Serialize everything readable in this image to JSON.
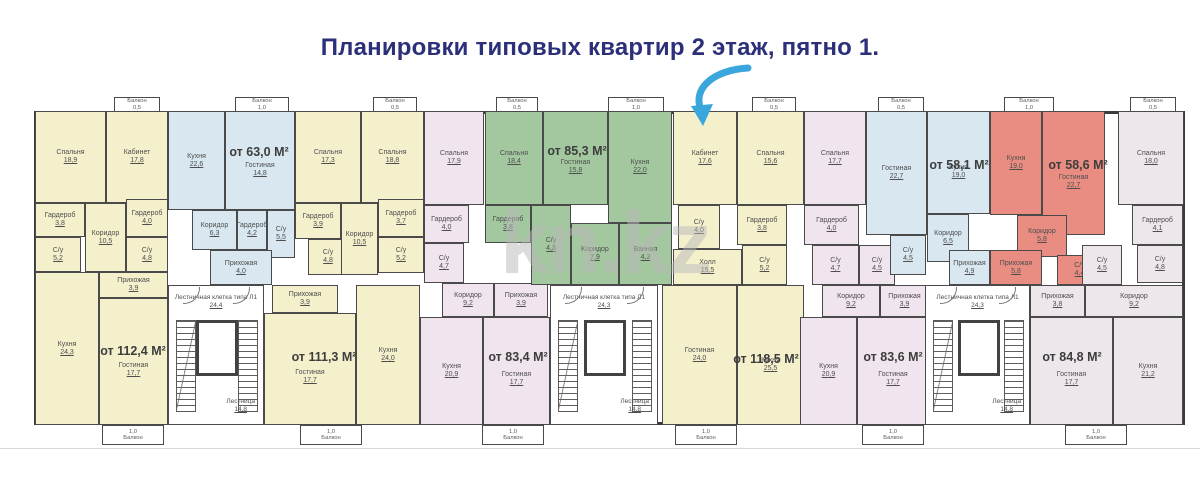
{
  "title": "Планировки типовых квартир 2 этаж, пятно 1.",
  "watermark": "kn.kz",
  "palette": {
    "yellow": "#f4f0cc",
    "blue": "#d8e7f0",
    "lavender": "#f0e4ee",
    "green": "#a3c89f",
    "red": "#e98d82",
    "pink": "#ede7ec",
    "wall": "#3a3a3a",
    "title": "#2c2f79",
    "arrow": "#3aa6dc",
    "watermark_gray": "#b9b9b9",
    "room_text": "#4e4e4e"
  },
  "plan": {
    "rooms": [
      {
        "n": "Спальня",
        "a": "18,9",
        "c": "yellow",
        "r": [
          3,
          16,
          71,
          92
        ]
      },
      {
        "n": "Кабинет",
        "a": "17,8",
        "c": "yellow",
        "r": [
          74,
          16,
          62,
          92
        ]
      },
      {
        "n": "Гардероб",
        "a": "3,8",
        "c": "yellow",
        "r": [
          3,
          108,
          50,
          34
        ]
      },
      {
        "n": "Гардероб",
        "a": "4,0",
        "c": "yellow",
        "r": [
          94,
          104,
          42,
          38
        ]
      },
      {
        "n": "С/у",
        "a": "5,2",
        "c": "yellow",
        "r": [
          3,
          142,
          46,
          35
        ]
      },
      {
        "n": "Коридор",
        "a": "10,5",
        "c": "yellow",
        "r": [
          53,
          108,
          41,
          69
        ]
      },
      {
        "n": "С/у",
        "a": "4,8",
        "c": "yellow",
        "r": [
          94,
          142,
          42,
          35
        ]
      },
      {
        "n": "Кухня",
        "a": "24,3",
        "c": "yellow",
        "r": [
          3,
          177,
          64,
          153
        ]
      },
      {
        "n": "Прихожая",
        "a": "3,9",
        "c": "yellow",
        "r": [
          67,
          177,
          69,
          26
        ]
      },
      {
        "n": "Гостиная",
        "a": "17,7",
        "c": "yellow",
        "r": [
          67,
          203,
          69,
          127
        ],
        "d": 16
      },
      {
        "n": "Кухня",
        "a": "22,6",
        "c": "blue",
        "r": [
          136,
          16,
          57,
          99
        ]
      },
      {
        "n": "Гостиная",
        "a": "14,8",
        "c": "blue",
        "r": [
          193,
          16,
          70,
          99
        ],
        "d": 18
      },
      {
        "n": "Коридор",
        "a": "6,3",
        "c": "blue",
        "r": [
          160,
          115,
          45,
          40
        ]
      },
      {
        "n": "Гардероб",
        "a": "4,2",
        "c": "blue",
        "r": [
          205,
          115,
          30,
          40
        ]
      },
      {
        "n": "С/у",
        "a": "5,5",
        "c": "blue",
        "r": [
          235,
          115,
          28,
          48
        ]
      },
      {
        "n": "Прихожая",
        "a": "4,0",
        "c": "blue",
        "r": [
          178,
          155,
          62,
          35
        ]
      },
      {
        "n": "Спальня",
        "a": "17,3",
        "c": "yellow",
        "r": [
          263,
          16,
          66,
          92
        ]
      },
      {
        "n": "Спальня",
        "a": "18,8",
        "c": "yellow",
        "r": [
          329,
          16,
          63,
          92
        ]
      },
      {
        "n": "Гардероб",
        "a": "3,9",
        "c": "yellow",
        "r": [
          263,
          108,
          46,
          36
        ]
      },
      {
        "n": "Гардероб",
        "a": "3,7",
        "c": "yellow",
        "r": [
          346,
          104,
          46,
          38
        ]
      },
      {
        "n": "С/у",
        "a": "4,8",
        "c": "yellow",
        "r": [
          276,
          144,
          40,
          36
        ]
      },
      {
        "n": "Коридор",
        "a": "10,5",
        "c": "yellow",
        "r": [
          309,
          108,
          37,
          72
        ]
      },
      {
        "n": "С/у",
        "a": "5,2",
        "c": "yellow",
        "r": [
          346,
          142,
          46,
          36
        ]
      },
      {
        "n": "Прихожая",
        "a": "3,9",
        "c": "yellow",
        "r": [
          240,
          190,
          66,
          28
        ]
      },
      {
        "n": "Гостиная",
        "a": "17,7",
        "c": "yellow",
        "r": [
          232,
          218,
          92,
          112
        ],
        "d": 16
      },
      {
        "n": "Кухня",
        "a": "24,0",
        "c": "yellow",
        "r": [
          324,
          190,
          64,
          140
        ]
      },
      {
        "n": "Спальня",
        "a": "17,9",
        "c": "lavender",
        "r": [
          392,
          16,
          60,
          94
        ]
      },
      {
        "n": "Гардероб",
        "a": "4,0",
        "c": "lavender",
        "r": [
          392,
          110,
          45,
          38
        ]
      },
      {
        "n": "С/у",
        "a": "4,7",
        "c": "lavender",
        "r": [
          392,
          148,
          40,
          40
        ]
      },
      {
        "n": "Коридор",
        "a": "9,2",
        "c": "lavender",
        "r": [
          410,
          188,
          52,
          34
        ]
      },
      {
        "n": "Прихожая",
        "a": "3,9",
        "c": "lavender",
        "r": [
          462,
          188,
          54,
          34
        ]
      },
      {
        "n": "Кухня",
        "a": "20,9",
        "c": "lavender",
        "r": [
          388,
          222,
          63,
          108
        ]
      },
      {
        "n": "Гостиная",
        "a": "17,7",
        "c": "lavender",
        "r": [
          451,
          222,
          67,
          108
        ],
        "d": 16
      },
      {
        "n": "Спальня",
        "a": "18,4",
        "c": "green",
        "r": [
          453,
          16,
          58,
          94
        ]
      },
      {
        "n": "Гостиная",
        "a": "15,8",
        "c": "green",
        "r": [
          511,
          16,
          65,
          94
        ],
        "d": 18
      },
      {
        "n": "Кухня",
        "a": "22,0",
        "c": "green",
        "r": [
          576,
          16,
          64,
          112
        ]
      },
      {
        "n": "Гардероб",
        "a": "3,8",
        "c": "green",
        "r": [
          453,
          110,
          46,
          38
        ]
      },
      {
        "n": "С/у",
        "a": "4,3",
        "c": "green",
        "r": [
          499,
          110,
          40,
          80
        ]
      },
      {
        "n": "Коридор",
        "a": "7,9",
        "c": "green",
        "r": [
          539,
          128,
          48,
          62
        ]
      },
      {
        "n": "Ванная",
        "a": "4,3",
        "c": "green",
        "r": [
          587,
          128,
          53,
          62
        ]
      },
      {
        "n": "Кабинет",
        "a": "17,6",
        "c": "yellow",
        "r": [
          641,
          16,
          64,
          94
        ]
      },
      {
        "n": "Спальня",
        "a": "15,6",
        "c": "yellow",
        "r": [
          705,
          16,
          67,
          94
        ]
      },
      {
        "n": "С/у",
        "a": "4,0",
        "c": "yellow",
        "r": [
          646,
          110,
          42,
          44
        ]
      },
      {
        "n": "Гардероб",
        "a": "3,8",
        "c": "yellow",
        "r": [
          705,
          110,
          50,
          40
        ]
      },
      {
        "n": "С/у",
        "a": "5,2",
        "c": "yellow",
        "r": [
          710,
          150,
          45,
          40
        ]
      },
      {
        "n": "Холл",
        "a": "15,5",
        "c": "yellow",
        "r": [
          641,
          154,
          69,
          36
        ]
      },
      {
        "n": "Гостиная",
        "a": "24,0",
        "c": "yellow",
        "r": [
          630,
          190,
          75,
          140
        ]
      },
      {
        "n": "Кухня",
        "a": "25,5",
        "c": "yellow",
        "r": [
          705,
          190,
          67,
          140
        ],
        "d": 20
      },
      {
        "n": "Спальня",
        "a": "17,7",
        "c": "lavender",
        "r": [
          772,
          16,
          62,
          94
        ]
      },
      {
        "n": "Гардероб",
        "a": "4,0",
        "c": "lavender",
        "r": [
          772,
          110,
          55,
          40
        ]
      },
      {
        "n": "С/у",
        "a": "4,7",
        "c": "lavender",
        "r": [
          780,
          150,
          47,
          40
        ]
      },
      {
        "n": "С/у",
        "a": "4,5",
        "c": "lavender",
        "r": [
          827,
          150,
          36,
          40
        ]
      },
      {
        "n": "Коридор",
        "a": "9,2",
        "c": "lavender",
        "r": [
          790,
          190,
          58,
          32
        ]
      },
      {
        "n": "Прихожая",
        "a": "3,9",
        "c": "lavender",
        "r": [
          848,
          190,
          49,
          32
        ]
      },
      {
        "n": "Кухня",
        "a": "20,9",
        "c": "lavender",
        "r": [
          768,
          222,
          57,
          108
        ]
      },
      {
        "n": "Гостиная",
        "a": "17,7",
        "c": "lavender",
        "r": [
          825,
          222,
          72,
          108
        ],
        "d": 16
      },
      {
        "n": "Гостиная",
        "a": "22,7",
        "c": "blue",
        "r": [
          834,
          16,
          61,
          124
        ]
      },
      {
        "n": "Кухня",
        "a": "19,0",
        "c": "blue",
        "r": [
          895,
          16,
          63,
          103
        ],
        "d": 18
      },
      {
        "n": "Коридор",
        "a": "6,5",
        "c": "blue",
        "r": [
          895,
          119,
          42,
          48
        ]
      },
      {
        "n": "С/у",
        "a": "4,5",
        "c": "blue",
        "r": [
          858,
          140,
          36,
          40
        ]
      },
      {
        "n": "Прихожая",
        "a": "4,9",
        "c": "blue",
        "r": [
          917,
          155,
          41,
          35
        ]
      },
      {
        "n": "Кухня",
        "a": "19,0",
        "c": "red",
        "r": [
          958,
          16,
          52,
          104
        ]
      },
      {
        "n": "Гостиная",
        "a": "22,7",
        "c": "red",
        "r": [
          1010,
          16,
          63,
          124
        ],
        "d": 18
      },
      {
        "n": "Коридор",
        "a": "5,8",
        "c": "red",
        "r": [
          985,
          120,
          50,
          42
        ]
      },
      {
        "n": "Прихожая",
        "a": "5,8",
        "c": "red",
        "r": [
          958,
          155,
          52,
          35
        ]
      },
      {
        "n": "С/у",
        "a": "4,4",
        "c": "red",
        "r": [
          1025,
          160,
          45,
          30
        ]
      },
      {
        "n": "Спальня",
        "a": "18,0",
        "c": "pink",
        "r": [
          1086,
          16,
          66,
          94
        ]
      },
      {
        "n": "Гардероб",
        "a": "4,1",
        "c": "pink",
        "r": [
          1100,
          110,
          51,
          40
        ]
      },
      {
        "n": "С/у",
        "a": "4,8",
        "c": "pink",
        "r": [
          1105,
          150,
          46,
          38
        ]
      },
      {
        "n": "С/у",
        "a": "4,5",
        "c": "pink",
        "r": [
          1050,
          150,
          40,
          40
        ]
      },
      {
        "n": "Прихожая",
        "a": "3,8",
        "c": "pink",
        "r": [
          998,
          190,
          55,
          32
        ]
      },
      {
        "n": "Коридор",
        "a": "9,2",
        "c": "pink",
        "r": [
          1053,
          190,
          98,
          32
        ]
      },
      {
        "n": "Кухня",
        "a": "21,2",
        "c": "pink",
        "r": [
          1081,
          222,
          70,
          108
        ]
      },
      {
        "n": "Гостиная",
        "a": "17,7",
        "c": "pink",
        "r": [
          998,
          222,
          83,
          108
        ],
        "d": 16
      }
    ],
    "area_labels": [
      {
        "t": "от 112,4 М²",
        "x": 101,
        "y": 256
      },
      {
        "t": "от 63,0 М²",
        "x": 227,
        "y": 57
      },
      {
        "t": "от 111,3 М²",
        "x": 292,
        "y": 262
      },
      {
        "t": "от 83,4 М²",
        "x": 486,
        "y": 262
      },
      {
        "t": "от 85,3 М²",
        "x": 545,
        "y": 56
      },
      {
        "t": "от 118,5 М²",
        "x": 734,
        "y": 264
      },
      {
        "t": "от 83,6 М²",
        "x": 861,
        "y": 262
      },
      {
        "t": "от 58,1 М²",
        "x": 927,
        "y": 70
      },
      {
        "t": "от 58,6 М²",
        "x": 1046,
        "y": 70
      },
      {
        "t": "от 84,8 М²",
        "x": 1040,
        "y": 262
      }
    ],
    "stairwells": [
      {
        "label": "Лестничная клетка типа Л1",
        "area": "24,4",
        "sub": "Лестница",
        "sub_area": "14,8",
        "r": [
          136,
          190,
          96,
          140
        ]
      },
      {
        "label": "Лестничная клетка типа Л1",
        "area": "24,3",
        "sub": "Лестница",
        "sub_area": "14,8",
        "r": [
          518,
          190,
          108,
          140
        ]
      },
      {
        "label": "Лестничная клетка типа Л1",
        "area": "24,3",
        "sub": "Лестница",
        "sub_area": "14,8",
        "r": [
          893,
          190,
          105,
          140
        ]
      }
    ],
    "balconies": [
      {
        "l": "Балкон",
        "a": "0,5",
        "r": [
          82,
          2,
          46,
          15
        ],
        "side": "top"
      },
      {
        "l": "Балкон",
        "a": "1,0",
        "r": [
          203,
          2,
          54,
          15
        ],
        "side": "top"
      },
      {
        "l": "Балкон",
        "a": "0,5",
        "r": [
          341,
          2,
          44,
          15
        ],
        "side": "top"
      },
      {
        "l": "Балкон",
        "a": "0,5",
        "r": [
          464,
          2,
          42,
          15
        ],
        "side": "top"
      },
      {
        "l": "Балкон",
        "a": "1,0",
        "r": [
          576,
          2,
          56,
          15
        ],
        "side": "top"
      },
      {
        "l": "Балкон",
        "a": "0,5",
        "r": [
          720,
          2,
          44,
          15
        ],
        "side": "top"
      },
      {
        "l": "Балкон",
        "a": "0,5",
        "r": [
          846,
          2,
          46,
          15
        ],
        "side": "top"
      },
      {
        "l": "Балкон",
        "a": "1,0",
        "r": [
          972,
          2,
          50,
          15
        ],
        "side": "top"
      },
      {
        "l": "Балкон",
        "a": "0,5",
        "r": [
          1098,
          2,
          46,
          15
        ],
        "side": "top"
      },
      {
        "l": "Балкон",
        "a": "1,0",
        "r": [
          70,
          330,
          62,
          20
        ],
        "side": "bottom"
      },
      {
        "l": "Балкон",
        "a": "1,0",
        "r": [
          268,
          330,
          62,
          20
        ],
        "side": "bottom"
      },
      {
        "l": "Балкон",
        "a": "1,0",
        "r": [
          450,
          330,
          62,
          20
        ],
        "side": "bottom"
      },
      {
        "l": "Балкон",
        "a": "1,0",
        "r": [
          643,
          330,
          62,
          20
        ],
        "side": "bottom"
      },
      {
        "l": "Балкон",
        "a": "1,0",
        "r": [
          830,
          330,
          62,
          20
        ],
        "side": "bottom"
      },
      {
        "l": "Балкон",
        "a": "1,0",
        "r": [
          1033,
          330,
          62,
          20
        ],
        "side": "bottom"
      }
    ]
  }
}
